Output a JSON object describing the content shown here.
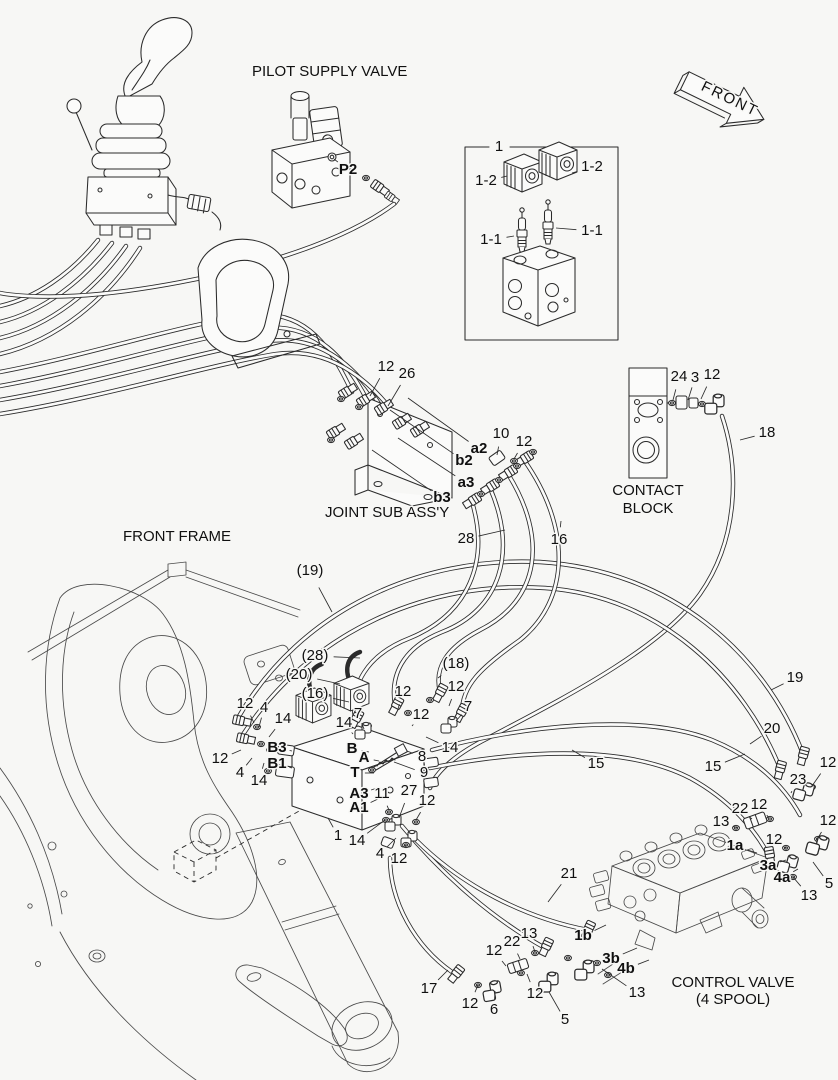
{
  "colors": {
    "background": "#f7f7f5",
    "ink": "#2b2b2b"
  },
  "labels": [
    {
      "t": "PILOT SUPPLY VALVE",
      "x": 252,
      "y": 72,
      "a": "start",
      "s": 15.5
    },
    {
      "t": "FRONT",
      "x": 702,
      "y": 86,
      "a": "start",
      "s": 15,
      "r": 26,
      "ls": 2
    },
    {
      "t": "1",
      "x": 499,
      "y": 147
    },
    {
      "t": "1-2",
      "x": 486,
      "y": 181,
      "lx": 507,
      "ly": 176
    },
    {
      "t": "1-2",
      "x": 592,
      "y": 167,
      "lx": 572,
      "ly": 173
    },
    {
      "t": "1-1",
      "x": 491,
      "y": 240,
      "lx": 514,
      "ly": 236
    },
    {
      "t": "1-1",
      "x": 592,
      "y": 231,
      "lx": 556,
      "ly": 228
    },
    {
      "t": "P2",
      "x": 348,
      "y": 170,
      "b": 1,
      "lx": 334,
      "ly": 159
    },
    {
      "t": "12",
      "x": 386,
      "y": 367,
      "lx": 370,
      "ly": 396
    },
    {
      "t": "26",
      "x": 407,
      "y": 374,
      "lx": 388,
      "ly": 406
    },
    {
      "t": "a2",
      "x": 479,
      "y": 449,
      "b": 1,
      "lx": 408,
      "ly": 398
    },
    {
      "t": "b2",
      "x": 464,
      "y": 461,
      "b": 1,
      "lx": 390,
      "ly": 410
    },
    {
      "t": "10",
      "x": 501,
      "y": 434,
      "lx": 497,
      "ly": 455
    },
    {
      "t": "12",
      "x": 524,
      "y": 442,
      "lx": 514,
      "ly": 459
    },
    {
      "t": "a3",
      "x": 466,
      "y": 483,
      "b": 1,
      "lx": 398,
      "ly": 438
    },
    {
      "t": "b3",
      "x": 442,
      "y": 498,
      "b": 1,
      "lx": 372,
      "ly": 450
    },
    {
      "t": "JOINT SUB ASS'Y",
      "x": 325,
      "y": 513,
      "a": "start",
      "s": 15.5
    },
    {
      "t": "28",
      "x": 466,
      "y": 539,
      "lx": 505,
      "ly": 530
    },
    {
      "t": "16",
      "x": 559,
      "y": 540,
      "lx": 561,
      "ly": 521
    },
    {
      "t": "24",
      "x": 679,
      "y": 377,
      "lx": 673,
      "ly": 400
    },
    {
      "t": "3",
      "x": 695,
      "y": 378,
      "lx": 688,
      "ly": 400
    },
    {
      "t": "12",
      "x": 712,
      "y": 375,
      "lx": 701,
      "ly": 399
    },
    {
      "t": "CONTACT",
      "x": 648,
      "y": 491,
      "s": 15.5
    },
    {
      "t": "BLOCK",
      "x": 648,
      "y": 509,
      "s": 15.5
    },
    {
      "t": "18",
      "x": 767,
      "y": 433,
      "lx": 740,
      "ly": 440
    },
    {
      "t": "FRONT FRAME",
      "x": 123,
      "y": 537,
      "a": "start",
      "s": 15.5
    },
    {
      "t": "(19)",
      "x": 310,
      "y": 571,
      "lx": 332,
      "ly": 612
    },
    {
      "t": "(28)",
      "x": 315,
      "y": 656,
      "lx": 360,
      "ly": 658
    },
    {
      "t": "(20)",
      "x": 299,
      "y": 675,
      "lx": 340,
      "ly": 684
    },
    {
      "t": "(16)",
      "x": 315,
      "y": 694,
      "lx": 349,
      "ly": 702
    },
    {
      "t": "(18)",
      "x": 456,
      "y": 664,
      "lx": 438,
      "ly": 678
    },
    {
      "t": "15",
      "x": 596,
      "y": 764,
      "lx": 572,
      "ly": 750
    },
    {
      "t": "15",
      "x": 713,
      "y": 767,
      "lx": 745,
      "ly": 754
    },
    {
      "t": "19",
      "x": 795,
      "y": 678,
      "lx": 771,
      "ly": 690
    },
    {
      "t": "20",
      "x": 772,
      "y": 729,
      "lx": 750,
      "ly": 744
    },
    {
      "t": "12",
      "x": 245,
      "y": 704,
      "lx": 254,
      "ly": 723
    },
    {
      "t": "4",
      "x": 264,
      "y": 708,
      "lx": 259,
      "ly": 727
    },
    {
      "t": "14",
      "x": 283,
      "y": 719,
      "lx": 269,
      "ly": 737
    },
    {
      "t": "12",
      "x": 220,
      "y": 759,
      "lx": 241,
      "ly": 750
    },
    {
      "t": "4",
      "x": 240,
      "y": 773,
      "lx": 252,
      "ly": 758
    },
    {
      "t": "14",
      "x": 259,
      "y": 781,
      "lx": 264,
      "ly": 763
    },
    {
      "t": "B3",
      "x": 277,
      "y": 748,
      "b": 1,
      "lx": 292,
      "ly": 751
    },
    {
      "t": "B1",
      "x": 277,
      "y": 764,
      "b": 1,
      "lx": 292,
      "ly": 768
    },
    {
      "t": "14",
      "x": 344,
      "y": 723,
      "lx": 353,
      "ly": 734
    },
    {
      "t": "7",
      "x": 358,
      "y": 714,
      "lx": 364,
      "ly": 729
    },
    {
      "t": "12",
      "x": 403,
      "y": 692,
      "lx": 398,
      "ly": 709
    },
    {
      "t": "12",
      "x": 421,
      "y": 715,
      "lx": 412,
      "ly": 726
    },
    {
      "t": "12",
      "x": 456,
      "y": 687,
      "lx": 449,
      "ly": 706
    },
    {
      "t": "7",
      "x": 468,
      "y": 707,
      "lx": 456,
      "ly": 721
    },
    {
      "t": "14",
      "x": 450,
      "y": 748,
      "lx": 426,
      "ly": 737
    },
    {
      "t": "8",
      "x": 422,
      "y": 757,
      "lx": 407,
      "ly": 751
    },
    {
      "t": "9",
      "x": 424,
      "y": 773,
      "lx": 394,
      "ly": 762
    },
    {
      "t": "B",
      "x": 352,
      "y": 749,
      "b": 1,
      "lx": 369,
      "ly": 752
    },
    {
      "t": "A",
      "x": 364,
      "y": 758,
      "b": 1,
      "lx": 379,
      "ly": 761
    },
    {
      "t": "T",
      "x": 355,
      "y": 773,
      "b": 1,
      "lx": 374,
      "ly": 773
    },
    {
      "t": "A3",
      "x": 359,
      "y": 794,
      "b": 1,
      "lx": 380,
      "ly": 787
    },
    {
      "t": "A1",
      "x": 359,
      "y": 808,
      "b": 1,
      "lx": 378,
      "ly": 799
    },
    {
      "t": "11",
      "x": 382,
      "y": 794,
      "lx": 389,
      "ly": 810
    },
    {
      "t": "27",
      "x": 409,
      "y": 791,
      "lx": 399,
      "ly": 818
    },
    {
      "t": "12",
      "x": 427,
      "y": 801,
      "lx": 416,
      "ly": 820
    },
    {
      "t": "1",
      "x": 338,
      "y": 836,
      "lx": 328,
      "ly": 818
    },
    {
      "t": "14",
      "x": 357,
      "y": 841,
      "lx": 385,
      "ly": 820
    },
    {
      "t": "4",
      "x": 380,
      "y": 854,
      "lx": 396,
      "ly": 838
    },
    {
      "t": "12",
      "x": 399,
      "y": 859,
      "lx": 406,
      "ly": 845
    },
    {
      "t": "12",
      "x": 828,
      "y": 763,
      "lx": 812,
      "ly": 786
    },
    {
      "t": "23",
      "x": 798,
      "y": 780,
      "lx": 791,
      "ly": 793
    },
    {
      "t": "12",
      "x": 759,
      "y": 805,
      "lx": 769,
      "ly": 818
    },
    {
      "t": "22",
      "x": 740,
      "y": 809,
      "lx": 752,
      "ly": 819
    },
    {
      "t": "13",
      "x": 721,
      "y": 822,
      "lx": 738,
      "ly": 828
    },
    {
      "t": "12",
      "x": 828,
      "y": 821,
      "lx": 818,
      "ly": 838
    },
    {
      "t": "12",
      "x": 774,
      "y": 840,
      "lx": 786,
      "ly": 848
    },
    {
      "t": "1a",
      "x": 735,
      "y": 846,
      "b": 1,
      "lx": 757,
      "ly": 853
    },
    {
      "t": "3a",
      "x": 768,
      "y": 866,
      "b": 1,
      "lx": 786,
      "ly": 860
    },
    {
      "t": "4a",
      "x": 782,
      "y": 878,
      "b": 1,
      "lx": 798,
      "ly": 869
    },
    {
      "t": "5",
      "x": 829,
      "y": 884,
      "lx": 813,
      "ly": 862
    },
    {
      "t": "13",
      "x": 809,
      "y": 896,
      "lx": 793,
      "ly": 877
    },
    {
      "t": "21",
      "x": 569,
      "y": 874,
      "lx": 548,
      "ly": 902
    },
    {
      "t": "13",
      "x": 529,
      "y": 934,
      "lx": 535,
      "ly": 952
    },
    {
      "t": "1b",
      "x": 583,
      "y": 936,
      "b": 1,
      "lx": 606,
      "ly": 925
    },
    {
      "t": "22",
      "x": 512,
      "y": 942,
      "lx": 520,
      "ly": 959
    },
    {
      "t": "12",
      "x": 494,
      "y": 951,
      "lx": 506,
      "ly": 966
    },
    {
      "t": "3b",
      "x": 611,
      "y": 959,
      "b": 1,
      "lx": 637,
      "ly": 948
    },
    {
      "t": "4b",
      "x": 626,
      "y": 969,
      "b": 1,
      "lx": 649,
      "ly": 960
    },
    {
      "t": "17",
      "x": 429,
      "y": 989,
      "lx": 448,
      "ly": 970
    },
    {
      "t": "12",
      "x": 470,
      "y": 1004,
      "lx": 478,
      "ly": 985
    },
    {
      "t": "6",
      "x": 494,
      "y": 1010,
      "lx": 495,
      "ly": 991
    },
    {
      "t": "12",
      "x": 535,
      "y": 994,
      "lx": 527,
      "ly": 974
    },
    {
      "t": "13",
      "x": 637,
      "y": 993,
      "lx": 602,
      "ly": 969
    },
    {
      "t": "5",
      "x": 565,
      "y": 1020,
      "lx": 549,
      "ly": 992
    },
    {
      "t": "CONTROL VALVE",
      "x": 733,
      "y": 983,
      "s": 15.5
    },
    {
      "t": "(4 SPOOL)",
      "x": 733,
      "y": 1000,
      "s": 15.5
    }
  ]
}
